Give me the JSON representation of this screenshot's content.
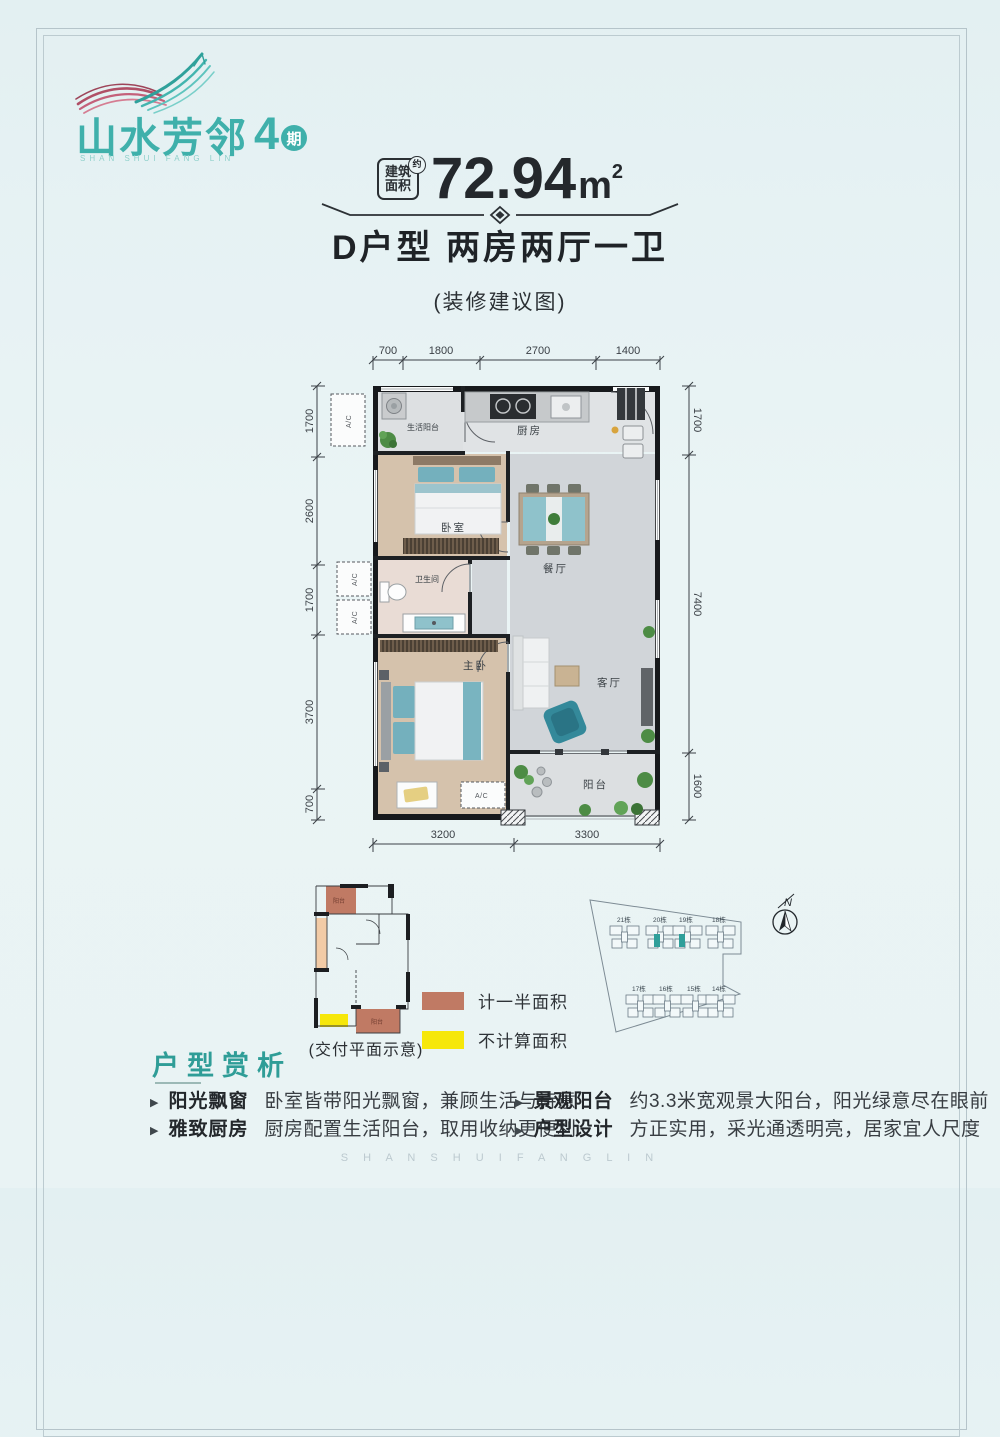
{
  "logo": {
    "title": "山水芳邻",
    "phase_number": "4",
    "phase_suffix": "期",
    "tagline": "SHAN SHUI FANG LIN"
  },
  "header": {
    "area_tag_line1": "建筑",
    "area_tag_line2": "面积",
    "area_approx": "约",
    "area_value": "72.94",
    "area_unit": "m",
    "area_unit_sup": "2",
    "title": "D户型  两房两厅一卫",
    "subtitle": "(装修建议图)"
  },
  "floor_plan": {
    "dims_top": [
      "700",
      "1800",
      "2700",
      "1400"
    ],
    "dims_left": [
      "1700",
      "2600",
      "1700",
      "3700",
      "700"
    ],
    "dims_right": [
      "1700",
      "7400",
      "1600"
    ],
    "dims_bottom": [
      "3200",
      "3300"
    ],
    "rooms": {
      "service_balcony": "生活阳台",
      "kitchen": "厨房",
      "bedroom": "卧室",
      "dining": "餐厅",
      "bathroom": "卫生间",
      "master_bedroom": "主卧",
      "living_room": "客厅",
      "balcony": "阳台",
      "ac": "A/C"
    }
  },
  "delivery_plan": {
    "caption": "(交付平面示意)",
    "top_balcony_label": "阳台",
    "bottom_balcony_label": "阳台",
    "legend": [
      {
        "color": "#c07a64",
        "label": "计一半面积"
      },
      {
        "color": "#f6e70a",
        "label": "不计算面积"
      }
    ]
  },
  "site_map": {
    "compass_label": "N",
    "buildings_top": [
      "21栋",
      "20栋",
      "19栋",
      "18栋"
    ],
    "buildings_bottom": [
      "17栋",
      "16栋",
      "15栋",
      "14栋"
    ],
    "highlight_color": "#2f9f9a"
  },
  "analysis": {
    "title": "户型赏析",
    "items": [
      {
        "label": "阳光飘窗",
        "text": "卧室皆带阳光飘窗，兼顾生活与诗意"
      },
      {
        "label": "雅致厨房",
        "text": "厨房配置生活阳台，取用收纳更便利"
      },
      {
        "label": "景观阳台",
        "text": "约3.3米宽观景大阳台，阳光绿意尽在眼前"
      },
      {
        "label": "户型设计",
        "text": "方正实用，采光通透明亮，居家宜人尺度"
      }
    ]
  },
  "watermark": "S H A N S H U I F A N G L I N"
}
